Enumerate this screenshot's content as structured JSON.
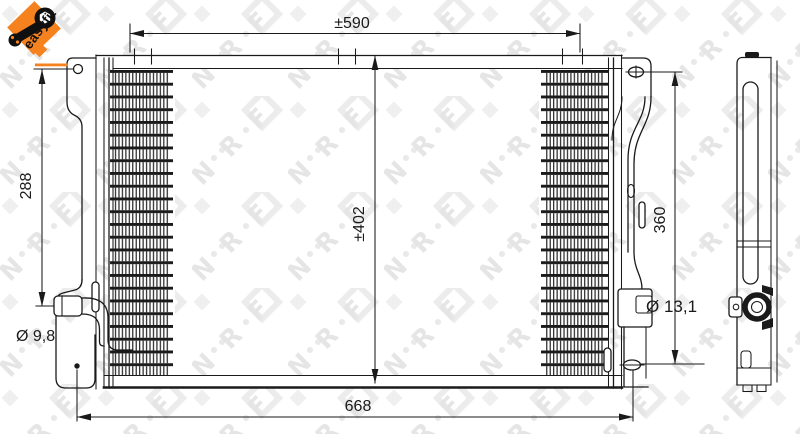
{
  "colors": {
    "accent_orange": "#f5821f",
    "line": "#1a1a1a",
    "watermark": "#e5e5e5"
  },
  "logo": {
    "label": "easyfit"
  },
  "watermark": {
    "letters": [
      "N",
      "R",
      "F"
    ]
  },
  "drawing": {
    "dimensions": {
      "core_width": "±590",
      "overall_width": "668",
      "left_bracket_height": "288",
      "core_height": "±402",
      "right_bracket_height": "360",
      "port_small_diameter": "Ø 9,8",
      "port_large_diameter": "Ø 13,1"
    }
  }
}
